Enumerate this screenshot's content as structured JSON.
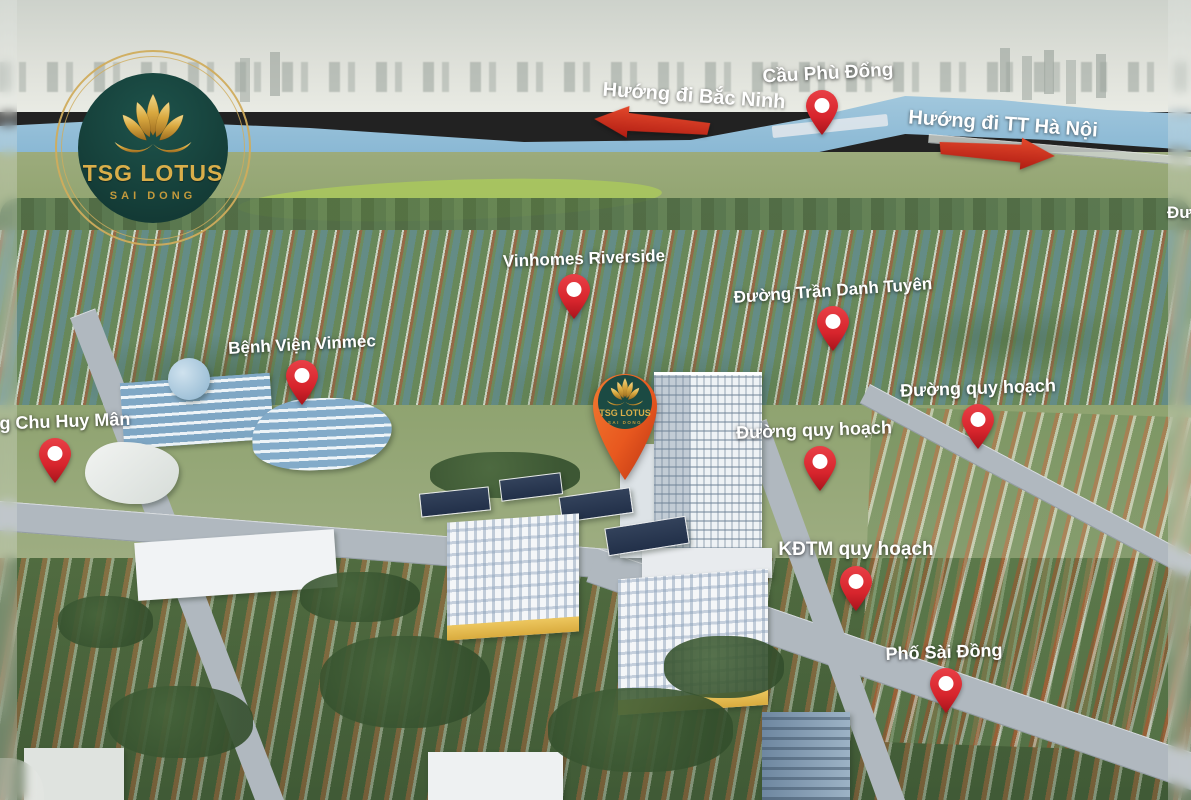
{
  "brand": {
    "name": "TSG LOTUS",
    "location": "SAI DONG"
  },
  "project_pin": {
    "title": "TSG LOTUS",
    "subtitle": "SAI DONG",
    "x": 625,
    "y": 484
  },
  "direction_arrows": [
    {
      "id": "bac-ninh",
      "label": "Hướng đi Bắc Ninh",
      "direction": "left",
      "x": 652,
      "y": 124,
      "tilt": 5,
      "label_dx": 42,
      "label_rot": 4
    },
    {
      "id": "ha-noi",
      "label": "Hướng đi TT Hà Nội",
      "direction": "right",
      "x": 997,
      "y": 152,
      "tilt": 4,
      "label_dx": 6,
      "label_rot": 4
    }
  ],
  "pins": [
    {
      "id": "cau-phu-dong",
      "label": "Cầu Phù Đổng",
      "x": 822,
      "y": 137,
      "size": 19,
      "label_dx": 6,
      "rot": -3
    },
    {
      "id": "vinhomes-riverside",
      "label": "Vinhomes Riverside",
      "x": 574,
      "y": 321,
      "size": 17,
      "label_dx": 10,
      "rot": -2
    },
    {
      "id": "duong-tran-danh-tuyen",
      "label": "Đường Trần Danh Tuyên",
      "x": 833,
      "y": 353,
      "size": 17,
      "label_dx": 0,
      "rot": -4
    },
    {
      "id": "benh-vien-vinmec",
      "label": "Bệnh Viện Vinmec",
      "x": 302,
      "y": 407,
      "size": 17,
      "label_dx": 0,
      "rot": -3
    },
    {
      "id": "duong-chu-huy-man",
      "label": "Đường Chu Huy Mân",
      "x": 55,
      "y": 485,
      "size": 18,
      "label_dx": -15,
      "rot": -2
    },
    {
      "id": "duong-quy-hoach-1",
      "label": "Đường quy hoạch",
      "x": 820,
      "y": 493,
      "size": 18,
      "label_dx": -6,
      "rot": -2
    },
    {
      "id": "duong-quy-hoach-2",
      "label": "Đường quy hoạch",
      "x": 978,
      "y": 451,
      "size": 18,
      "label_dx": 0,
      "rot": -2
    },
    {
      "id": "kdtm-quy-hoach",
      "label": "KĐTM quy hoạch",
      "x": 856,
      "y": 613,
      "size": 19,
      "label_dx": 0,
      "rot": 0
    },
    {
      "id": "pho-sai-dong",
      "label": "Phố Sài Đồng",
      "x": 946,
      "y": 715,
      "size": 18,
      "label_dx": -2,
      "rot": -2
    }
  ],
  "partial_edge_label": {
    "text": "Đư",
    "x": 1167,
    "y": 203
  },
  "colors": {
    "pin_red": "#d7242c",
    "pin_red_dark": "#a8141c",
    "arrow_red": "#d8251b",
    "project_pin_orange": "#e8581f",
    "brand_teal": "#17453f",
    "brand_gold": "#d9ae4a",
    "label_text": "#ffffff",
    "river_blue": "#7db0d0"
  }
}
